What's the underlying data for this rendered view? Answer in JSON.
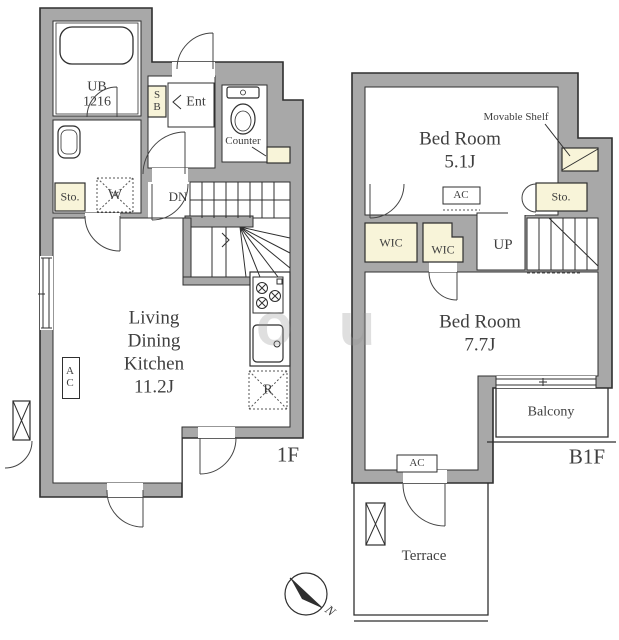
{
  "colors": {
    "wall_fill": "#a8a8a8",
    "closet_fill": "#f8f4d9",
    "line": "#2f2f2f",
    "text": "#3f3f3f"
  },
  "watermark": {
    "text": "ou"
  },
  "compass": {
    "north_label": "N"
  },
  "floor_1f": {
    "floor_label": "1F",
    "bath_label": "UB",
    "bath_size": "1216",
    "shoe_box_label": "SB",
    "entrance_label": "Ent",
    "counter_label": "Counter",
    "storage_label": "Sto.",
    "washer_label": "W",
    "stairs_label": "DN",
    "ldk_line1": "Living",
    "ldk_line2": "Dining",
    "ldk_line3": "Kitchen",
    "ldk_size": "11.2J",
    "ac_label": "AC",
    "fridge_label": "R"
  },
  "floor_b1f": {
    "floor_label": "B1F",
    "bedroom1_name": "Bed Room",
    "bedroom1_size": "5.1J",
    "movable_shelf_label": "Movable Shelf",
    "ac1_label": "AC",
    "storage_label": "Sto.",
    "wic1_label": "WIC",
    "wic2_label": "WIC",
    "stairs_label": "UP",
    "bedroom2_name": "Bed Room",
    "bedroom2_size": "7.7J",
    "balcony_label": "Balcony",
    "ac2_label": "AC",
    "terrace_label": "Terrace"
  }
}
